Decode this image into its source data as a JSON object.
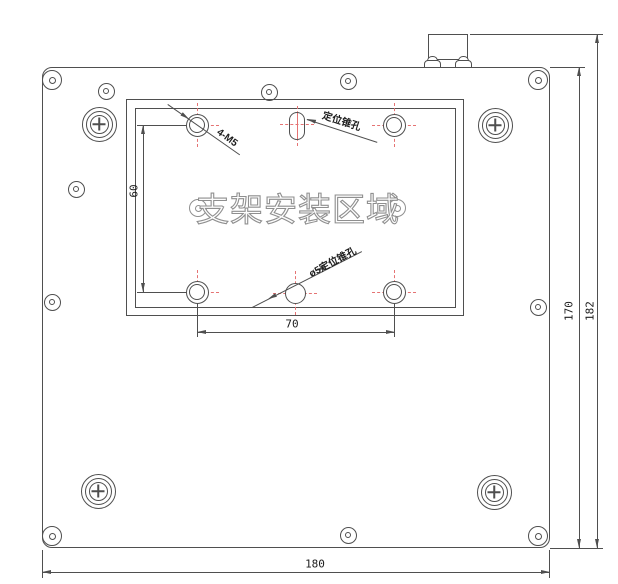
{
  "drawing": {
    "area_label": "支架安装区域",
    "leader_labels": {
      "thread_holes": "4-M5",
      "locating_taper_hole": "定位锥孔",
      "pin_locating_taper_hole": "ø5定位锥孔"
    },
    "dimensions": {
      "plate_width": "180",
      "plate_height": "170",
      "total_height": "182",
      "hole_pitch_x": "70",
      "hole_pitch_y": "60"
    },
    "colors": {
      "line": "#4f4f4f",
      "center_mark": "#e57373",
      "hollow_text": "#8f8f8f"
    }
  }
}
